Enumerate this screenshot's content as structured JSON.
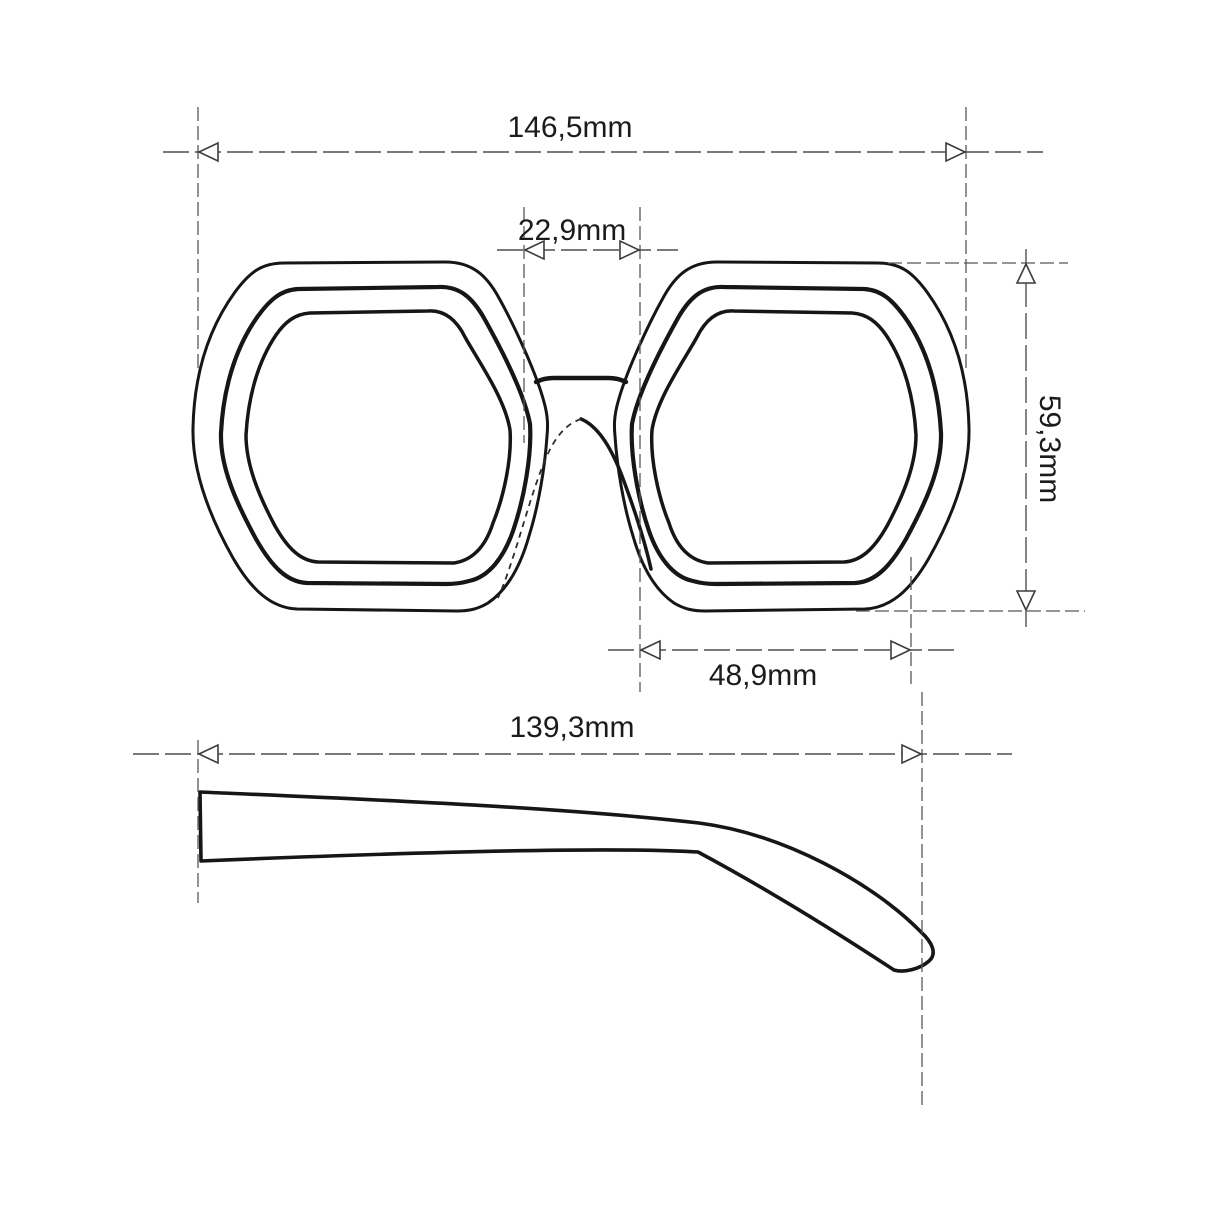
{
  "drawing": {
    "dimensions": {
      "total_width": {
        "label": "146,5mm",
        "value_mm": 146.5
      },
      "bridge_width": {
        "label": "22,9mm",
        "value_mm": 22.9
      },
      "lens_height": {
        "label": "59,3mm",
        "value_mm": 59.3
      },
      "lens_width": {
        "label": "48,9mm",
        "value_mm": 48.9
      },
      "temple_length": {
        "label": "139,3mm",
        "value_mm": 139.3
      }
    },
    "colors": {
      "background": "#ffffff",
      "frame_outline": "#161616",
      "dimension_line": "#4f4f4f",
      "label_text": "#1b1b1b"
    }
  }
}
